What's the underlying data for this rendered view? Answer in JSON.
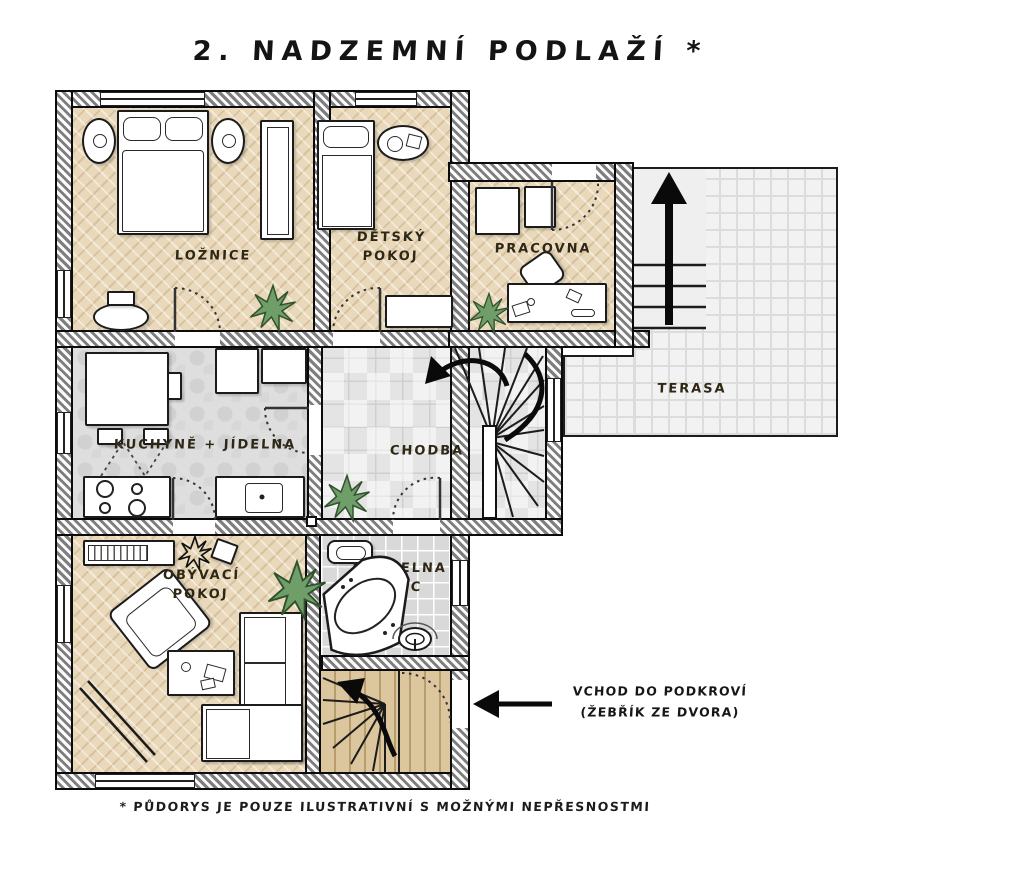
{
  "title": "2. NADZEMNÍ PODLAŽÍ *",
  "rooms": {
    "loznice": {
      "label": "LOŽNICE"
    },
    "detsky": {
      "label1": "DĚTSKÝ",
      "label2": "POKOJ"
    },
    "pracovna": {
      "label": "PRACOVNA"
    },
    "terasa": {
      "label": "TERASA"
    },
    "kuchyne": {
      "label": "KUCHYNĚ + JÍDELNA"
    },
    "chodba": {
      "label": "CHODBA"
    },
    "obyvaci": {
      "label1": "OBÝVACÍ",
      "label2": "POKOJ"
    },
    "koupelna": {
      "label1": "KOUPELNA",
      "label2": "+ WC"
    }
  },
  "annotations": {
    "attic_entrance_line1": "VCHOD DO PODKROVÍ",
    "attic_entrance_line2": "(ŽEBŘÍK ZE DVORA)"
  },
  "footnote": "* PŮDORYS JE POUZE ILUSTRATIVNÍ S MOŽNÝMI NEPŘESNOSTMI",
  "colors": {
    "wood_floor": "#e9d9ba",
    "tile_floor": "#dedede",
    "terrace_paving": "#f2f2f2",
    "wall_hatch": "#7e7e7e",
    "outline": "#0b0b0b",
    "plant_green": "#6f9e68",
    "label_text": "#2e2715"
  }
}
